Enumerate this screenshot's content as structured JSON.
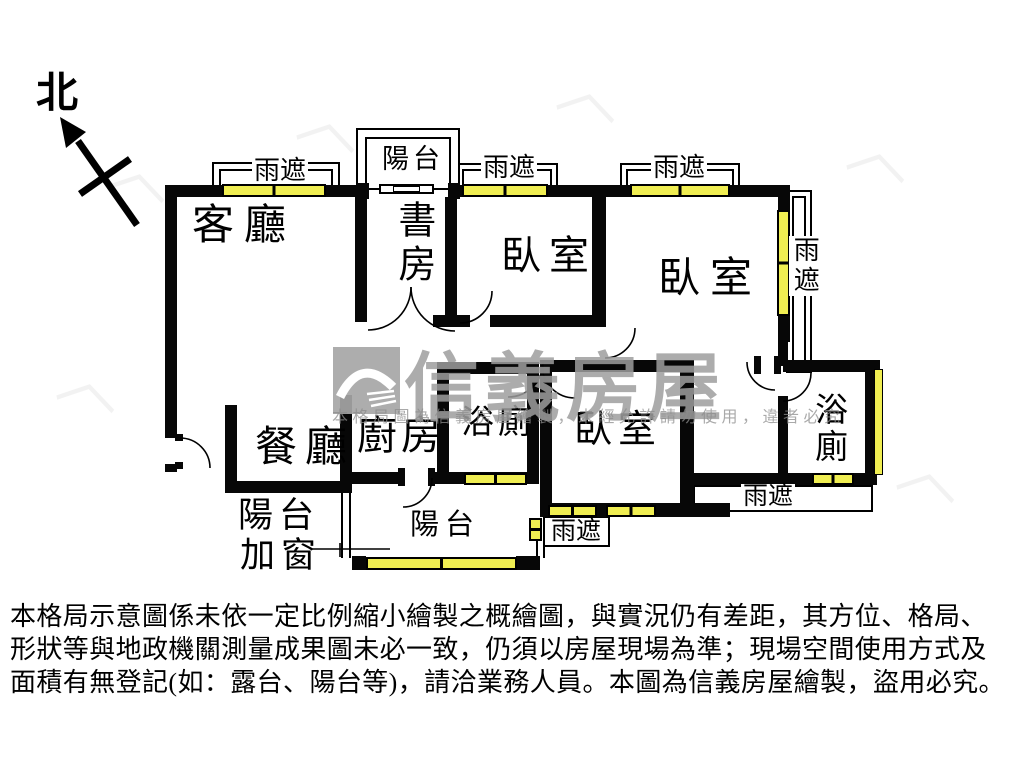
{
  "north": {
    "label": "北"
  },
  "labels": {
    "living": "客廳",
    "dining": "餐廳",
    "kitchen": "廚房",
    "study": "書房",
    "bedroom": "臥室",
    "bath": "浴廁",
    "balcony": "陽台",
    "rain_cover": "雨遮",
    "balcony_added_window_line1": "陽台",
    "balcony_added_window_line2": "加窗"
  },
  "watermark": {
    "brand": "信義房屋",
    "notice": "本格局圖為信義房屋繪製，未經允許請勿使用，違者必究",
    "pattern_glyph": "︿"
  },
  "disclaimer": {
    "line1": "本格局示意圖係未依一定比例縮小繪製之概繪圖，與實況仍有差距，其方位、格局、",
    "line2": "形狀等與地政機關測量成果圖未必一致，仍須以房屋現場為準；現場空間使用方式及",
    "line3": "面積有無登記(如：露台、陽台等)，請洽業務人員。本圖為信義房屋繪製，盜用必究。"
  },
  "colors": {
    "wall": "#070707",
    "window_yellow": "#f0ee52",
    "watermark_gray": "#a9a9a9"
  }
}
